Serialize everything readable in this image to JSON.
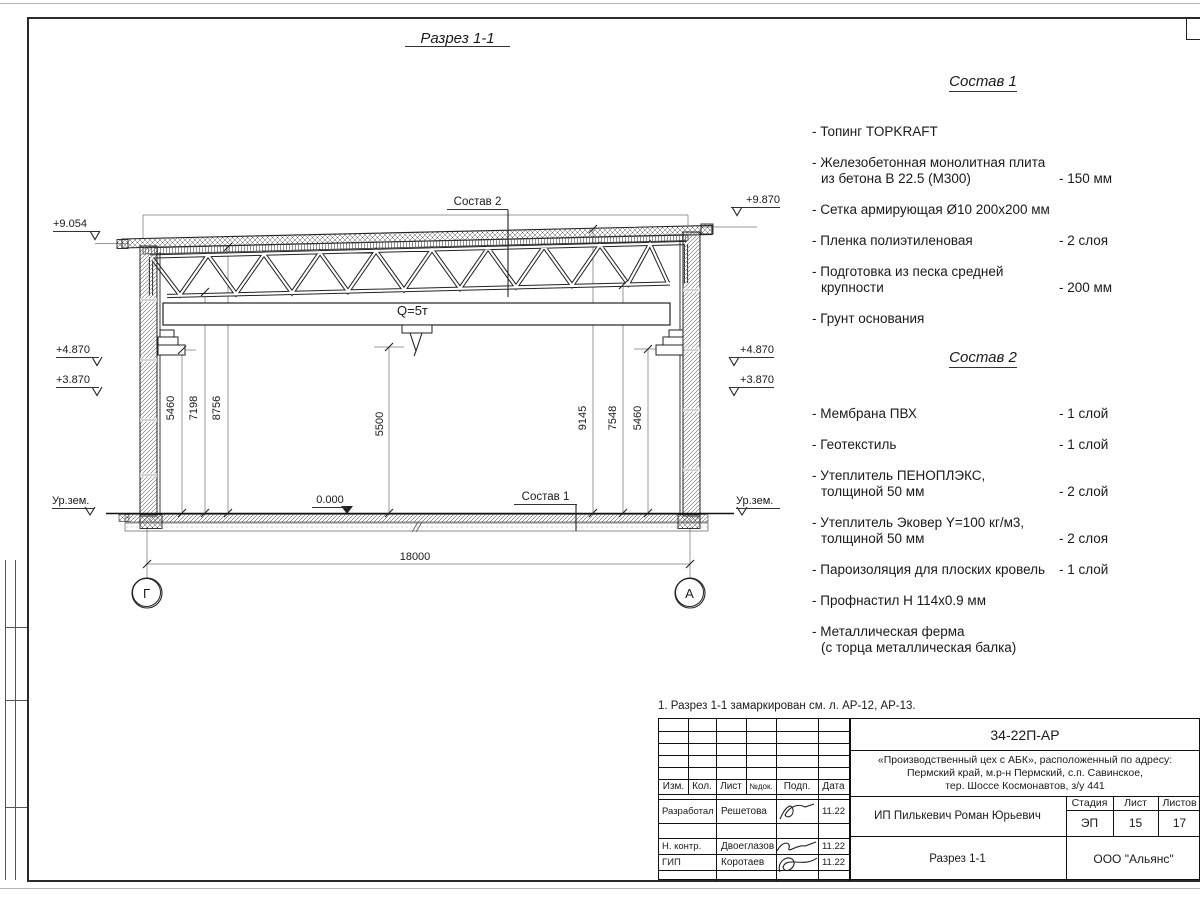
{
  "sheet": {
    "note": "1. Разрез 1-1 замаркирован см. л. АР-12, АР-13."
  },
  "section": {
    "title": "Разрез 1-1",
    "callout_top": "Состав 2",
    "callout_bottom": "Состав 1",
    "crane_label": "Q=5т",
    "level_zero": "0.000",
    "ground_left": "Ур.зем.",
    "ground_right": "Ур.зем.",
    "elev": {
      "left_roof": "+9.054",
      "right_roof": "+9.870",
      "left_crane": "+4.870",
      "left_low": "+3.870",
      "right_crane": "+4.870",
      "right_low": "+3.870"
    },
    "dims": {
      "left": [
        "5460",
        "7198",
        "8756"
      ],
      "center": "5500",
      "right": [
        "9145",
        "7548",
        "5460"
      ],
      "span": "18000"
    },
    "axes": {
      "left": "Г",
      "right": "А"
    }
  },
  "sostav1": {
    "title": "Состав 1",
    "items": [
      {
        "name": "- Топинг TOPKRAFT",
        "value": ""
      },
      {
        "name": "- Железобетонная  монолитная плита\nиз бетона В 22.5 (М300)",
        "value": "- 150 мм"
      },
      {
        "name": "- Сетка армирующая Ø10 200х200 мм",
        "value": ""
      },
      {
        "name": "- Пленка полиэтиленовая",
        "value": "-  2 слоя"
      },
      {
        "name": "- Подготовка из песка средней\nкрупности",
        "value": "- 200 мм"
      },
      {
        "name": "- Грунт основания",
        "value": ""
      }
    ]
  },
  "sostav2": {
    "title": "Состав 2",
    "items": [
      {
        "name": "- Мембрана ПВХ",
        "value": "- 1 слой"
      },
      {
        "name": "- Геотекстиль",
        "value": "- 1 слой"
      },
      {
        "name": "- Утеплитель ПЕНОПЛЭКС,\nтолщиной 50 мм",
        "value": "- 2 слой"
      },
      {
        "name": "- Утеплитель Эковер Y=100 кг/м3,\nтолщиной 50 мм",
        "value": "- 2 слоя"
      },
      {
        "name": "- Пароизоляция для плоских кровель",
        "value": "- 1 слой"
      },
      {
        "name": "- Профнастил Н 114х0.9 мм",
        "value": ""
      },
      {
        "name": "- Металлическая ферма\n(с торца металлическая балка)",
        "value": ""
      }
    ]
  },
  "titleblock": {
    "doc_number": "34-22П-АР",
    "project_line1": "«Производственный цех с АБК», расположенный по адресу:",
    "project_line2": "Пермский край, м.р-н Пермский, с.п. Савинское,",
    "project_line3": "тер. Шоссе Космонавтов, з/у 441",
    "client": "ИП Пилькевич Роман Юрьевич",
    "company": "ООО \"Альянс\"",
    "section_name": "Разрез 1-1",
    "stage_label": "Стадия",
    "sheet_label": "Лист",
    "sheets_label": "Листов",
    "stage": "ЭП",
    "sheet_num": "15",
    "sheets_total": "17",
    "col_izm": "Изм.",
    "col_kol": "Кол.",
    "col_list": "Лист",
    "col_ndok": "№док.",
    "col_podp": "Подп.",
    "col_data": "Дата",
    "rows": [
      {
        "role": "Разработал",
        "name": "Решетова",
        "date": "11.22"
      },
      {
        "role": "Н. контр.",
        "name": "Двоеглазов",
        "date": "11.22"
      },
      {
        "role": "ГИП",
        "name": "Коротаев",
        "date": "11.22"
      }
    ]
  }
}
